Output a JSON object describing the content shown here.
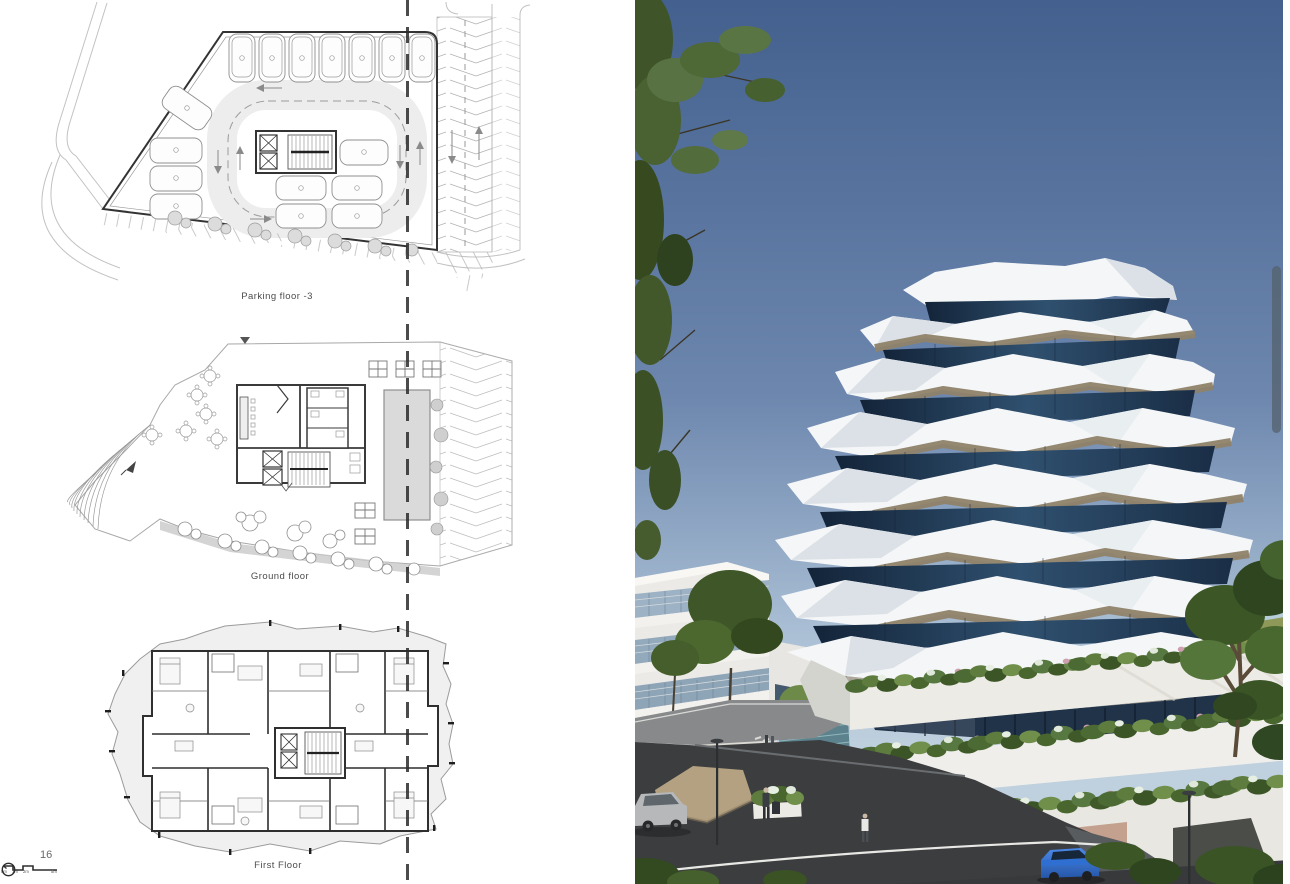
{
  "document": {
    "page_number": "16",
    "plans": {
      "parking": {
        "label": "Parking floor -3"
      },
      "ground": {
        "label": "Ground floor"
      },
      "first": {
        "label": "First Floor"
      }
    },
    "scale_bar": {
      "labels": [
        "0m",
        "1m",
        "2m",
        "5m"
      ]
    }
  },
  "render": {
    "colors": {
      "sky_top": "#43608e",
      "sky_horizon": "#abc0d5",
      "facade_white": "#f4f6f7",
      "glass_dark": "#1c3048",
      "soffit_tan": "#8f8269",
      "soffit_grey": "#9d988e",
      "foliage": "#47602f",
      "asphalt": "#3b3d3f",
      "terrace_white": "#edebe6",
      "car_blue": "#2f6fd2",
      "car_silver": "#b6b8ba"
    }
  },
  "viewer": {
    "scrollbar_thumb_color": "#566370"
  }
}
